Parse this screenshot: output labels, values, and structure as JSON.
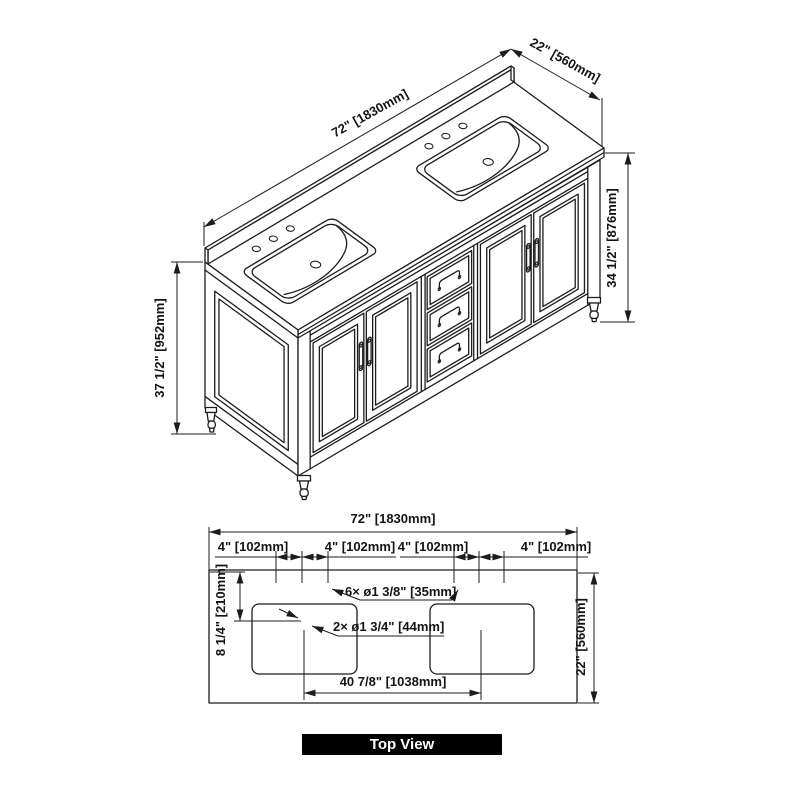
{
  "drawing": {
    "colors": {
      "line": "#1c1c1c",
      "background": "#ffffff",
      "label_bg": "#000000",
      "label_text": "#ffffff"
    },
    "iso_view": {
      "dim_width": "72\" [1830mm]",
      "dim_depth": "22\" [560mm]",
      "dim_height_to_countertop": "34 1/2\" [876mm]",
      "dim_height_overall": "37 1/2\" [952mm]"
    },
    "top_view": {
      "label": "Top View",
      "dim_width": "72\" [1830mm]",
      "dim_depth": "22\" [560mm]",
      "faucet_spacing": [
        "4\" [102mm]",
        "4\" [102mm]",
        "4\" [102mm]",
        "4\" [102mm]"
      ],
      "callout_faucet_holes": "6× ø1 3/8\" [35mm]",
      "callout_drain_holes": "2× ø1 3/4\" [44mm]",
      "dim_drain_spacing": "40 7/8\" [1038mm]",
      "dim_drain_setback": "8 1/4\" [210mm]"
    }
  }
}
